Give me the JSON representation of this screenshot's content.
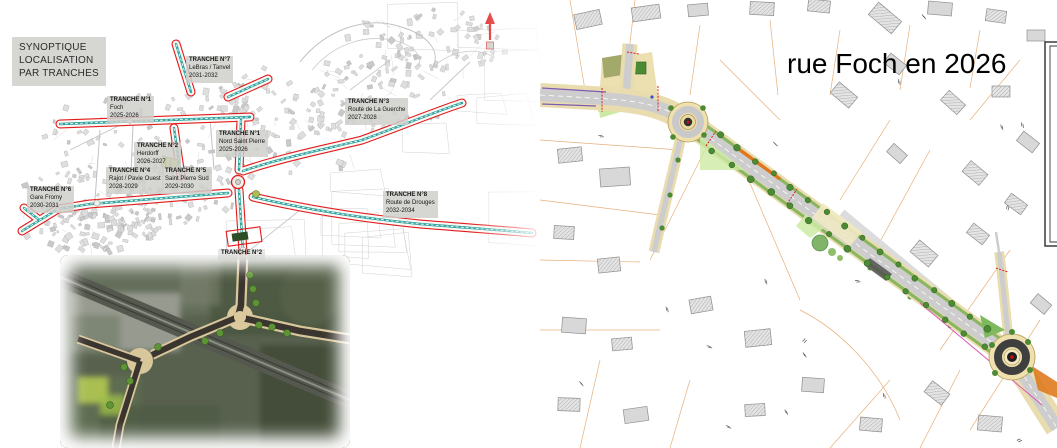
{
  "left_panel": {
    "title_lines": [
      "SYNOPTIQUE",
      "LOCALISATION",
      "PAR TRANCHES"
    ],
    "labels": [
      {
        "name": "TRANCHE N°7",
        "street": "LeBras / Tanvel",
        "years": "2031-2032"
      },
      {
        "name": "TRANCHE N°1",
        "street": "Foch",
        "years": "2025-2026"
      },
      {
        "name": "TRANCHE N°3",
        "street": "Route de La Guerche",
        "years": "2027-2028"
      },
      {
        "name": "TRANCHE N°1",
        "street": "Nord Saint Pierre",
        "years": "2025-2026"
      },
      {
        "name": "TRANCHE N°2",
        "street": "Herdorff",
        "years": "2026-2027"
      },
      {
        "name": "TRANCHE N°4",
        "street": "Rajot / Pavie Ouest",
        "years": "2028-2029"
      },
      {
        "name": "TRANCHE N°5",
        "street": "Saint Pierre Sud",
        "years": "2029-2030"
      },
      {
        "name": "TRANCHE N°6",
        "street": "Gare Fromy",
        "years": "2030-2031"
      },
      {
        "name": "TRANCHE N°8",
        "street": "Route de Drouges",
        "years": "2032-2034"
      },
      {
        "name": "TRANCHE N°2",
        "street": "",
        "years": ""
      }
    ],
    "icons": [
      {
        "name": "north-arrow-icon",
        "glyph": "↑"
      }
    ]
  },
  "right_panel": {
    "title": "rue Foch en 2026"
  },
  "colors": {
    "tranche_outline": "#e31b1b",
    "street_line": "#2fa39b",
    "label_bg": "#d6d6d3",
    "plan_parcel_line": "#e2a263",
    "road_asphalt": "#cdcdcd",
    "sidewalk": "#e9dcae",
    "planting_strip": "#8ab661",
    "tree_green": "#4c8a33",
    "cycle_lane_orange": "#e0761d",
    "roundabout_fill": "#efe0ae",
    "north_arrow_red": "#e01010"
  }
}
